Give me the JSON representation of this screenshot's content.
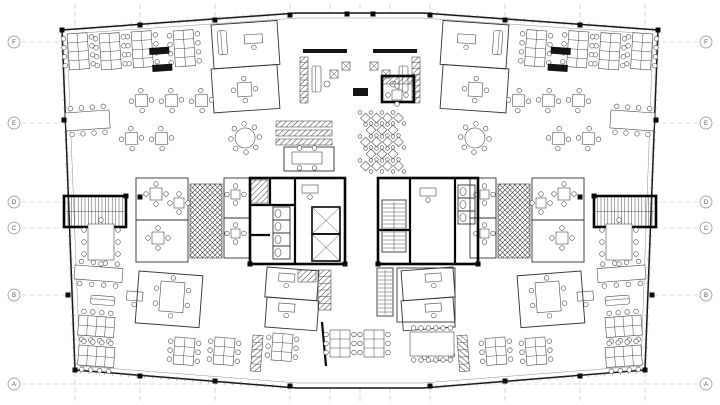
{
  "floorplan": {
    "title": "office-floor-plan",
    "colors": {
      "background": "#ffffff",
      "walls": "#141414",
      "core_walls": "#060606",
      "furniture": "#4a4a4a",
      "gridline": "#b9b9b9",
      "bubble_text": "#555555"
    },
    "grid": {
      "rows": [
        {
          "label": "F",
          "y": 42
        },
        {
          "label": "E",
          "y": 123
        },
        {
          "label": "D",
          "y": 202
        },
        {
          "label": "C",
          "y": 228
        },
        {
          "label": "B",
          "y": 295
        },
        {
          "label": "A",
          "y": 384
        }
      ],
      "cols": [
        75,
        140,
        215,
        290,
        330,
        360,
        390,
        430,
        505,
        580,
        645
      ]
    },
    "outline": [
      [
        62,
        30
      ],
      [
        297,
        13
      ],
      [
        423,
        13
      ],
      [
        658,
        30
      ],
      [
        645,
        370
      ],
      [
        423,
        388
      ],
      [
        297,
        388
      ],
      [
        75,
        370
      ]
    ],
    "outline_inner": [
      [
        67,
        34
      ],
      [
        298,
        18
      ],
      [
        422,
        18
      ],
      [
        653,
        34
      ],
      [
        641,
        366
      ],
      [
        422,
        383
      ],
      [
        298,
        383
      ],
      [
        80,
        366
      ]
    ],
    "tick_segments": [
      [
        62,
        30,
        297,
        13
      ],
      [
        423,
        13,
        658,
        30
      ],
      [
        75,
        371,
        297,
        388
      ],
      [
        423,
        388,
        645,
        371
      ],
      [
        62,
        30,
        75,
        370
      ],
      [
        658,
        30,
        645,
        370
      ]
    ],
    "columns": [
      [
        62,
        30
      ],
      [
        140,
        25
      ],
      [
        215,
        20
      ],
      [
        290,
        15
      ],
      [
        347,
        14
      ],
      [
        373,
        14
      ],
      [
        430,
        15
      ],
      [
        505,
        20
      ],
      [
        580,
        25
      ],
      [
        658,
        30
      ],
      [
        75,
        370
      ],
      [
        140,
        376
      ],
      [
        215,
        381
      ],
      [
        290,
        386
      ],
      [
        430,
        386
      ],
      [
        505,
        381
      ],
      [
        580,
        376
      ],
      [
        645,
        370
      ],
      [
        64,
        120
      ],
      [
        656,
        120
      ],
      [
        68,
        295
      ],
      [
        652,
        295
      ],
      [
        126,
        196
      ],
      [
        594,
        196
      ],
      [
        250,
        264
      ],
      [
        345,
        264
      ],
      [
        378,
        264
      ],
      [
        478,
        264
      ],
      [
        140,
        197
      ],
      [
        580,
        197
      ]
    ],
    "wing_items": [
      {
        "t": "benchV",
        "x": 68,
        "y": 33,
        "rows": 4
      },
      {
        "t": "benchV",
        "x": 100,
        "y": 33,
        "rows": 4
      },
      {
        "t": "benchV",
        "x": 132,
        "y": 31,
        "rows": 4
      },
      {
        "t": "benchV",
        "x": 174,
        "y": 30,
        "rows": 4
      },
      {
        "t": "hv",
        "x": 150,
        "y": 47,
        "w": 20,
        "h": 7
      },
      {
        "t": "hv",
        "x": 153,
        "y": 64,
        "w": 20,
        "h": 7
      },
      {
        "t": "room",
        "x": 212,
        "y": 24,
        "w": 66,
        "h": 44
      },
      {
        "t": "sofa",
        "x": 218,
        "y": 30,
        "w": 9,
        "h": 24
      },
      {
        "t": "deskChair",
        "x": 245,
        "y": 34,
        "w": 18,
        "h": 9
      },
      {
        "t": "room",
        "x": 212,
        "y": 68,
        "w": 66,
        "h": 44
      },
      {
        "t": "sq4",
        "x": 238,
        "y": 82,
        "s": 14
      },
      {
        "t": "meetH",
        "x": 66,
        "y": 112,
        "w": 44,
        "h": 18,
        "tc": 4,
        "bc": 4
      },
      {
        "t": "sq4",
        "x": 136,
        "y": 94,
        "s": 12
      },
      {
        "t": "sq4",
        "x": 166,
        "y": 94,
        "s": 12
      },
      {
        "t": "sq4",
        "x": 196,
        "y": 94,
        "s": 12
      },
      {
        "t": "sq4",
        "x": 126,
        "y": 132,
        "s": 12
      },
      {
        "t": "sq4",
        "x": 156,
        "y": 132,
        "s": 12
      },
      {
        "t": "round8",
        "x": 246,
        "y": 137,
        "r": 10
      },
      {
        "t": "stair",
        "x": 64,
        "y": 196,
        "w": 62,
        "h": 31
      },
      {
        "t": "meetV",
        "x": 88,
        "y": 224,
        "w": 26,
        "h": 36
      },
      {
        "t": "meetH",
        "x": 74,
        "y": 266,
        "w": 48,
        "h": 14,
        "tc": 4,
        "bc": 4
      },
      {
        "t": "room",
        "x": 136,
        "y": 178,
        "w": 52,
        "h": 42
      },
      {
        "t": "sq4",
        "x": 150,
        "y": 188,
        "s": 12
      },
      {
        "t": "sq4",
        "x": 174,
        "y": 198,
        "s": 10
      },
      {
        "t": "room",
        "x": 136,
        "y": 220,
        "w": 52,
        "h": 42
      },
      {
        "t": "sq4",
        "x": 152,
        "y": 232,
        "s": 12
      },
      {
        "t": "xhatch",
        "x": 190,
        "y": 184,
        "w": 32,
        "h": 74
      },
      {
        "t": "room",
        "x": 224,
        "y": 178,
        "w": 26,
        "h": 40
      },
      {
        "t": "sq4",
        "x": 231,
        "y": 190,
        "s": 9
      },
      {
        "t": "room",
        "x": 224,
        "y": 218,
        "w": 26,
        "h": 40
      },
      {
        "t": "sq4",
        "x": 231,
        "y": 229,
        "s": 9
      },
      {
        "t": "sofa",
        "x": 90,
        "y": 296,
        "w": 24,
        "h": 9
      },
      {
        "t": "deskChair",
        "x": 126,
        "y": 292,
        "w": 16,
        "h": 9
      },
      {
        "t": "benchH",
        "x": 78,
        "y": 316,
        "cols": 4
      },
      {
        "t": "benchH",
        "x": 78,
        "y": 346,
        "cols": 4
      },
      {
        "t": "room",
        "x": 138,
        "y": 272,
        "w": 64,
        "h": 52
      },
      {
        "t": "meetV",
        "x": 160,
        "y": 282,
        "w": 24,
        "h": 30
      },
      {
        "t": "benchV",
        "x": 174,
        "y": 338,
        "rows": 3
      },
      {
        "t": "benchV",
        "x": 214,
        "y": 338,
        "rows": 3
      },
      {
        "t": "lockers",
        "x": 252,
        "y": 336,
        "w": 10,
        "h": 36,
        "n": 5
      },
      {
        "t": "benchV",
        "x": 272,
        "y": 334,
        "rows": 3
      },
      {
        "t": "room",
        "x": 266,
        "y": 268,
        "w": 52,
        "h": 30
      },
      {
        "t": "deskChair",
        "x": 278,
        "y": 274,
        "w": 16,
        "h": 8
      },
      {
        "t": "room",
        "x": 266,
        "y": 298,
        "w": 52,
        "h": 30
      },
      {
        "t": "deskChair",
        "x": 278,
        "y": 304,
        "w": 16,
        "h": 8
      }
    ],
    "center_items": [
      {
        "t": "hv",
        "x": 303,
        "y": 49,
        "w": 44,
        "h": 4
      },
      {
        "t": "hv",
        "x": 373,
        "y": 49,
        "w": 44,
        "h": 4
      },
      {
        "t": "lockers",
        "x": 300,
        "y": 57,
        "w": 8,
        "h": 46,
        "n": 8
      },
      {
        "t": "lockers",
        "x": 412,
        "y": 57,
        "w": 8,
        "h": 46,
        "n": 8
      },
      {
        "t": "sofa",
        "x": 312,
        "y": 66,
        "w": 9,
        "h": 26
      },
      {
        "t": "sofa",
        "x": 399,
        "y": 66,
        "w": 9,
        "h": 26
      },
      {
        "t": "armX",
        "x": 334,
        "y": 74
      },
      {
        "t": "armX",
        "x": 346,
        "y": 66
      },
      {
        "t": "armX",
        "x": 374,
        "y": 66
      },
      {
        "t": "armX",
        "x": 386,
        "y": 74
      },
      {
        "t": "chairO",
        "x": 327,
        "y": 84
      },
      {
        "t": "chairO",
        "x": 393,
        "y": 84
      },
      {
        "t": "hv",
        "x": 353,
        "y": 88,
        "w": 15,
        "h": 8
      },
      {
        "t": "cafeGrid",
        "x": 382,
        "y": 118,
        "rows": 5,
        "cols": 4,
        "dx": 11,
        "dy": 12
      },
      {
        "t": "hatch",
        "x": 276,
        "y": 121,
        "w": 56,
        "h": 6
      },
      {
        "t": "hatch",
        "x": 276,
        "y": 130,
        "w": 56,
        "h": 6
      },
      {
        "t": "hatch",
        "x": 276,
        "y": 139,
        "w": 56,
        "h": 6
      },
      {
        "t": "room",
        "x": 284,
        "y": 147,
        "w": 50,
        "h": 24
      },
      {
        "t": "meetH",
        "x": 292,
        "y": 152,
        "w": 30,
        "h": 12,
        "tc": 2,
        "bc": 2
      },
      {
        "t": "coreRect",
        "x": 382,
        "y": 76,
        "w": 32,
        "h": 26
      },
      {
        "t": "hatch",
        "x": 383,
        "y": 77,
        "w": 30,
        "h": 7
      },
      {
        "t": "sq4",
        "x": 392,
        "y": 90,
        "s": 10
      },
      {
        "t": "coreRect",
        "x": 250,
        "y": 178,
        "w": 95,
        "h": 86
      },
      {
        "t": "coreLine",
        "x1": 295,
        "y1": 178,
        "x2": 295,
        "y2": 264
      },
      {
        "t": "coreLine",
        "x1": 250,
        "y1": 205,
        "x2": 295,
        "y2": 205
      },
      {
        "t": "coreLine",
        "x1": 270,
        "y1": 178,
        "x2": 270,
        "y2": 205
      },
      {
        "t": "coreLine",
        "x1": 250,
        "y1": 235,
        "x2": 270,
        "y2": 235
      },
      {
        "t": "hatch",
        "x": 251,
        "y": 180,
        "w": 17,
        "h": 23
      },
      {
        "t": "wc",
        "x": 273,
        "y": 207,
        "n": 4
      },
      {
        "t": "elev",
        "x": 312,
        "y": 207,
        "w": 28,
        "h": 27
      },
      {
        "t": "elev",
        "x": 312,
        "y": 234,
        "w": 28,
        "h": 27
      },
      {
        "t": "deskChair",
        "x": 302,
        "y": 185,
        "w": 16,
        "h": 8
      },
      {
        "t": "coreRect",
        "x": 378,
        "y": 178,
        "w": 100,
        "h": 86
      },
      {
        "t": "coreLine",
        "x1": 410,
        "y1": 178,
        "x2": 410,
        "y2": 264
      },
      {
        "t": "coreLine",
        "x1": 455,
        "y1": 178,
        "x2": 455,
        "y2": 264
      },
      {
        "t": "coreLine",
        "x1": 378,
        "y1": 230,
        "x2": 410,
        "y2": 230
      },
      {
        "t": "stairV",
        "x": 382,
        "y": 200,
        "w": 24,
        "h": 52
      },
      {
        "t": "wc",
        "x": 458,
        "y": 185,
        "n": 3
      },
      {
        "t": "deskChair",
        "x": 420,
        "y": 188,
        "w": 16,
        "h": 8
      },
      {
        "t": "lockers",
        "x": 318,
        "y": 270,
        "w": 13,
        "h": 40,
        "n": 6
      },
      {
        "t": "hatch",
        "x": 298,
        "y": 270,
        "w": 18,
        "h": 12
      },
      {
        "t": "stairV",
        "x": 377,
        "y": 268,
        "w": 16,
        "h": 48
      },
      {
        "t": "room",
        "x": 397,
        "y": 268,
        "w": 58,
        "h": 54
      },
      {
        "t": "coreLine",
        "x1": 322,
        "y1": 322,
        "x2": 326,
        "y2": 366
      },
      {
        "t": "benchV",
        "x": 330,
        "y": 330,
        "rows": 3
      },
      {
        "t": "benchV",
        "x": 364,
        "y": 330,
        "rows": 3
      },
      {
        "t": "meetH",
        "x": 410,
        "y": 332,
        "w": 44,
        "h": 24,
        "tc": 6,
        "bc": 6
      }
    ]
  }
}
